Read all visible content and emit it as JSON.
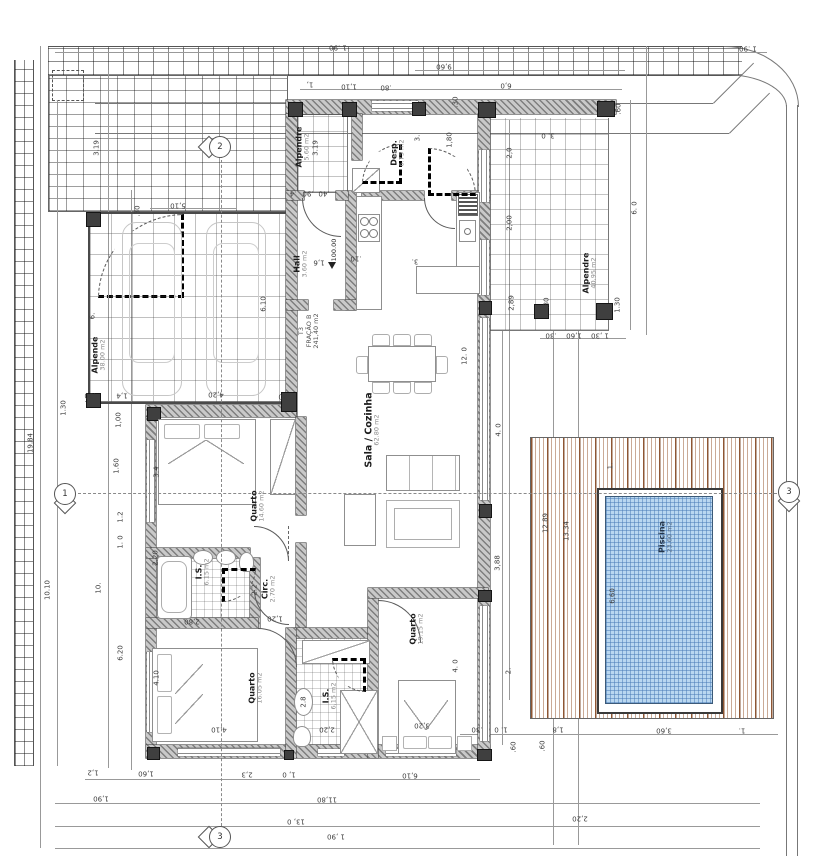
{
  "unit": {
    "code": "T3",
    "fraction": "FRAÇÃO B",
    "area": "241,40 m2"
  },
  "rooms": [
    {
      "name": "Alpende",
      "area": "38.00 m2",
      "x": 99,
      "y": 355
    },
    {
      "name": "Alpendre",
      "area": "5.60 m2",
      "x": 303,
      "y": 147
    },
    {
      "name": "Desp.",
      "area": "6.75 m2",
      "x": 398,
      "y": 153
    },
    {
      "name": "Hall",
      "area": "3.60 m2",
      "x": 301,
      "y": 264
    },
    {
      "name": "Sala / Cozinha",
      "area": "62.80 m2",
      "x": 373,
      "y": 430,
      "big": true
    },
    {
      "name": "Quarto",
      "area": "14.60 m2",
      "x": 258,
      "y": 506
    },
    {
      "name": "I.S.",
      "area": "6.15 m2",
      "x": 203,
      "y": 572
    },
    {
      "name": "Circ.",
      "area": "2.70 m2",
      "x": 269,
      "y": 589
    },
    {
      "name": "Quarto",
      "area": "16.05 m2",
      "x": 256,
      "y": 688
    },
    {
      "name": "I.S.",
      "area": "6,15 m2",
      "x": 330,
      "y": 696
    },
    {
      "name": "Quarto",
      "area": "19.15 m2",
      "x": 417,
      "y": 629
    },
    {
      "name": "Alpendre",
      "area": "40,95 m2",
      "x": 590,
      "y": 273
    },
    {
      "name": "Piscina",
      "area": "23.60 m2",
      "x": 666,
      "y": 537,
      "pool": true
    }
  ],
  "dims": [
    {
      "t": "1 .90",
      "x": 338,
      "y": 47,
      "r": 180
    },
    {
      "t": "1 .90",
      "x": 748,
      "y": 48,
      "r": 180
    },
    {
      "t": "9,60",
      "x": 444,
      "y": 66,
      "r": 180
    },
    {
      "t": "6,0",
      "x": 506,
      "y": 85,
      "r": 180
    },
    {
      "t": "1,",
      "x": 310,
      "y": 84,
      "r": 180
    },
    {
      "t": "1,10",
      "x": 349,
      "y": 86,
      "r": 180
    },
    {
      "t": ".80",
      "x": 386,
      "y": 87,
      "r": 180
    },
    {
      "t": "5,10",
      "x": 178,
      "y": 205,
      "r": 180
    },
    {
      "t": "3.19",
      "x": 97,
      "y": 148,
      "r": 90
    },
    {
      "t": ".30",
      "x": 138,
      "y": 211,
      "r": 90
    },
    {
      "t": "6.",
      "x": 93,
      "y": 316,
      "r": 90
    },
    {
      "t": "19.84",
      "x": 31,
      "y": 443,
      "r": 90
    },
    {
      "t": "1.30",
      "x": 64,
      "y": 408,
      "r": 90
    },
    {
      "t": "1,00",
      "x": 119,
      "y": 420,
      "r": 90
    },
    {
      "t": "1.60",
      "x": 117,
      "y": 466,
      "r": 90
    },
    {
      "t": "10.10",
      "x": 48,
      "y": 590,
      "r": 90
    },
    {
      "t": "10.",
      "x": 99,
      "y": 588,
      "r": 90
    },
    {
      "t": "1.2",
      "x": 121,
      "y": 517,
      "r": 90
    },
    {
      "t": "1. 0",
      "x": 121,
      "y": 542,
      "r": 90
    },
    {
      "t": "6.20",
      "x": 121,
      "y": 653,
      "r": 90
    },
    {
      "t": "3.4",
      "x": 157,
      "y": 472,
      "r": 90
    },
    {
      "t": "2.20",
      "x": 156,
      "y": 558,
      "r": 90
    },
    {
      "t": "4.10",
      "x": 157,
      "y": 678,
      "r": 90
    },
    {
      "t": ".30",
      "x": 90,
      "y": 395,
      "r": 180
    },
    {
      "t": "1,4",
      "x": 122,
      "y": 395,
      "r": 180
    },
    {
      "t": "4,20",
      "x": 216,
      "y": 394,
      "r": 180
    },
    {
      "t": ".30",
      "x": 284,
      "y": 396,
      "r": 180
    },
    {
      "t": "6.10",
      "x": 264,
      "y": 304,
      "r": 90
    },
    {
      "t": ".4",
      "x": 293,
      "y": 193,
      "r": 180
    },
    {
      "t": ".90",
      "x": 308,
      "y": 193,
      "r": 180
    },
    {
      "t": ".40",
      "x": 324,
      "y": 193,
      "r": 180
    },
    {
      "t": "3.19",
      "x": 316,
      "y": 148,
      "r": 90
    },
    {
      "t": "1,80",
      "x": 450,
      "y": 140,
      "r": 90
    },
    {
      "t": "3.",
      "x": 418,
      "y": 138,
      "r": 90
    },
    {
      "t": ".30",
      "x": 456,
      "y": 102,
      "r": 90
    },
    {
      "t": "1,6",
      "x": 319,
      "y": 262,
      "r": 180
    },
    {
      "t": ".10",
      "x": 356,
      "y": 258,
      "r": 180
    },
    {
      "t": "3.",
      "x": 415,
      "y": 261,
      "r": 180
    },
    {
      "t": "12. 0",
      "x": 465,
      "y": 356,
      "r": 90
    },
    {
      "t": "2,0",
      "x": 510,
      "y": 153,
      "r": 90
    },
    {
      "t": "2,00",
      "x": 510,
      "y": 223,
      "r": 90
    },
    {
      "t": "2,89",
      "x": 512,
      "y": 303,
      "r": 90
    },
    {
      "t": "3. 0",
      "x": 548,
      "y": 135,
      "r": 180
    },
    {
      "t": ".60",
      "x": 619,
      "y": 109,
      "r": 90
    },
    {
      "t": "6. 0",
      "x": 635,
      "y": 208,
      "r": 90
    },
    {
      "t": "1.30",
      "x": 618,
      "y": 305,
      "r": 90
    },
    {
      "t": ".30",
      "x": 547,
      "y": 303,
      "r": 90
    },
    {
      "t": ".30",
      "x": 551,
      "y": 335,
      "r": 180
    },
    {
      "t": "1,60",
      "x": 574,
      "y": 335,
      "r": 180
    },
    {
      "t": "1 ,30",
      "x": 600,
      "y": 335,
      "r": 180
    },
    {
      "t": "1.",
      "x": 611,
      "y": 466,
      "r": 90
    },
    {
      "t": "12.89",
      "x": 546,
      "y": 523,
      "r": 90
    },
    {
      "t": "13.34",
      "x": 567,
      "y": 531,
      "r": 90
    },
    {
      "t": "6,60",
      "x": 613,
      "y": 596,
      "r": 90
    },
    {
      "t": "4. 0",
      "x": 499,
      "y": 430,
      "r": 90
    },
    {
      "t": "3,88",
      "x": 498,
      "y": 563,
      "r": 90
    },
    {
      "t": "2.",
      "x": 509,
      "y": 671,
      "r": 90
    },
    {
      "t": "2.2",
      "x": 255,
      "y": 590,
      "r": 90
    },
    {
      "t": "1,20",
      "x": 275,
      "y": 618,
      "r": 180
    },
    {
      "t": "2,80",
      "x": 192,
      "y": 621,
      "r": 180
    },
    {
      "t": "2,20",
      "x": 327,
      "y": 729,
      "r": 180
    },
    {
      "t": "2.8",
      "x": 304,
      "y": 702,
      "r": 90
    },
    {
      "t": "4,10",
      "x": 219,
      "y": 729,
      "r": 180
    },
    {
      "t": "3,20",
      "x": 422,
      "y": 725,
      "r": 180
    },
    {
      "t": "4. 0",
      "x": 456,
      "y": 666,
      "r": 90
    },
    {
      "t": "1,2",
      "x": 93,
      "y": 772,
      "r": 180
    },
    {
      "t": "1,60",
      "x": 146,
      "y": 773,
      "r": 180
    },
    {
      "t": "2,3",
      "x": 247,
      "y": 774,
      "r": 180
    },
    {
      "t": "1, 0",
      "x": 289,
      "y": 774,
      "r": 180
    },
    {
      "t": "6,10",
      "x": 410,
      "y": 775,
      "r": 180
    },
    {
      "t": "1,90",
      "x": 101,
      "y": 798,
      "r": 180
    },
    {
      "t": "11,80",
      "x": 327,
      "y": 799,
      "r": 180
    },
    {
      "t": "13, 0",
      "x": 296,
      "y": 821,
      "r": 180
    },
    {
      "t": "1 ,90",
      "x": 336,
      "y": 836,
      "r": 180
    },
    {
      "t": "2,20",
      "x": 580,
      "y": 818,
      "r": 180
    },
    {
      "t": "1. 0",
      "x": 501,
      "y": 729,
      "r": 180
    },
    {
      "t": ".30",
      "x": 477,
      "y": 729,
      "r": 180
    },
    {
      "t": ".60",
      "x": 514,
      "y": 747,
      "r": 90
    },
    {
      "t": ".60",
      "x": 543,
      "y": 746,
      "r": 90
    },
    {
      "t": "1,8",
      "x": 558,
      "y": 729,
      "r": 180
    },
    {
      "t": "3,60",
      "x": 664,
      "y": 730,
      "r": 180
    },
    {
      "t": "1.",
      "x": 742,
      "y": 730,
      "r": 180
    }
  ],
  "markers": [
    {
      "n": "2",
      "x": 219,
      "y": 146,
      "side": "left"
    },
    {
      "n": "1",
      "x": 64,
      "y": 493,
      "side": "bottom"
    },
    {
      "n": "3",
      "x": 219,
      "y": 836,
      "side": "left"
    },
    {
      "n": "3",
      "x": 788,
      "y": 491,
      "side": "bottom"
    }
  ],
  "level": {
    "t": "100.00",
    "x": 334,
    "y": 250
  },
  "colors": {
    "wall_hatch": "#7e7e7e",
    "pool_water": "#b9d7f0",
    "deck_wood": "#a5673f",
    "dim_text": "#3d3d3d",
    "label_text": "#1c1c1c"
  }
}
